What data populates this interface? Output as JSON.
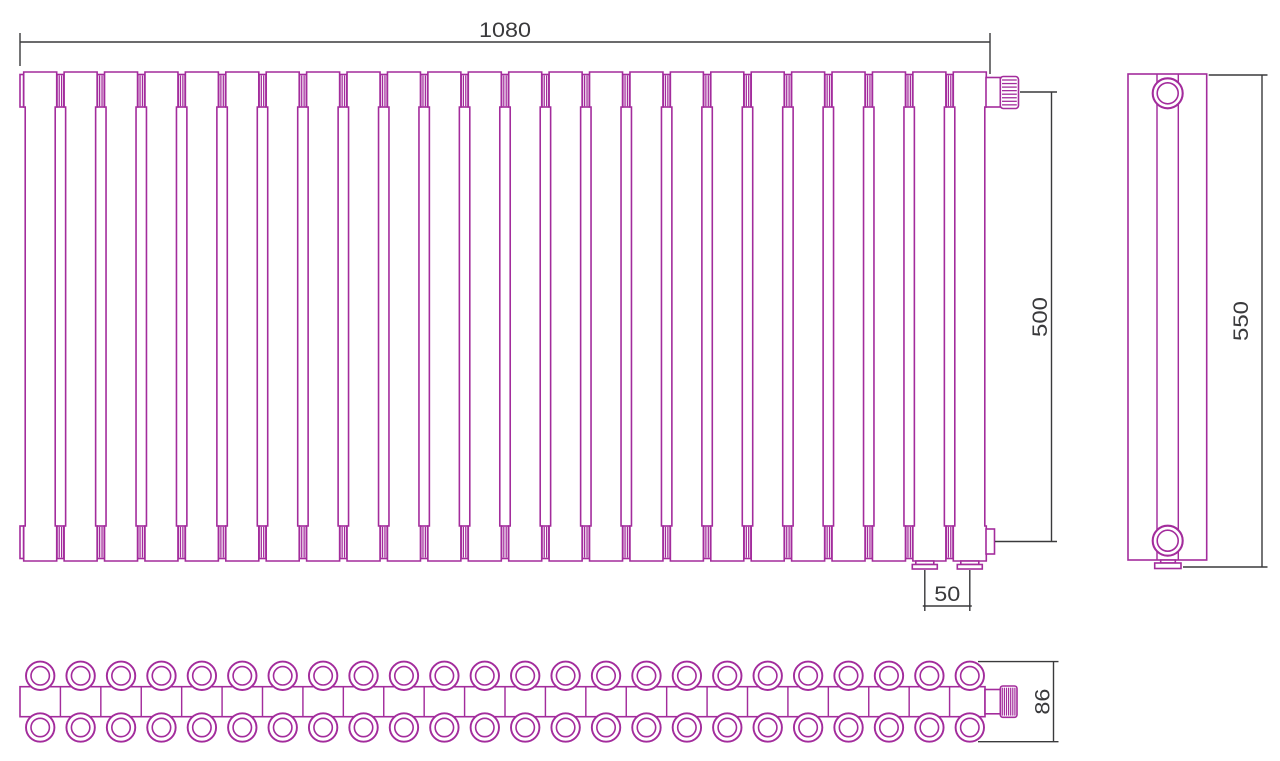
{
  "drawing": {
    "colors": {
      "outline": "#A32C9C",
      "dimension": "#3A3A3C",
      "background": "#FFFFFF"
    },
    "views": {
      "front": {
        "label": "front-view",
        "sections": 24,
        "dimensions": {
          "overall_width": "1080",
          "connection_height": "500",
          "tapping_spacing": "50"
        }
      },
      "side": {
        "label": "side-view",
        "dimensions": {
          "overall_height": "550"
        }
      },
      "top": {
        "label": "top-view",
        "columns": 24,
        "rows": 2,
        "dimensions": {
          "overall_depth": "86"
        }
      }
    }
  }
}
